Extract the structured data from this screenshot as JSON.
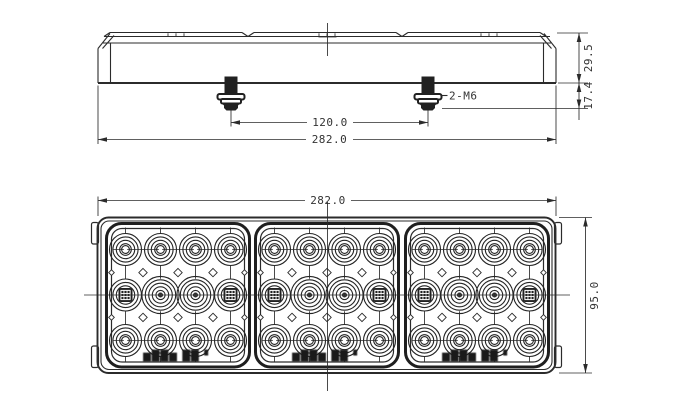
{
  "side_view": {
    "bolt_label": "2-M6",
    "dim_bolt_spacing": "120.0",
    "dim_overall_width": "282.0",
    "dim_body_height": "29.5",
    "dim_stud_length": "17.4"
  },
  "front_view": {
    "dim_overall_width": "282.0",
    "dim_overall_height": "95.0",
    "panel_count": 3,
    "led_columns": 4,
    "led_rows": 3,
    "stamp": "▆██▆ ██ ▘"
  },
  "colors": {
    "line": "#2b2b2b",
    "background": "#ffffff",
    "fill_dark": "#212121"
  }
}
